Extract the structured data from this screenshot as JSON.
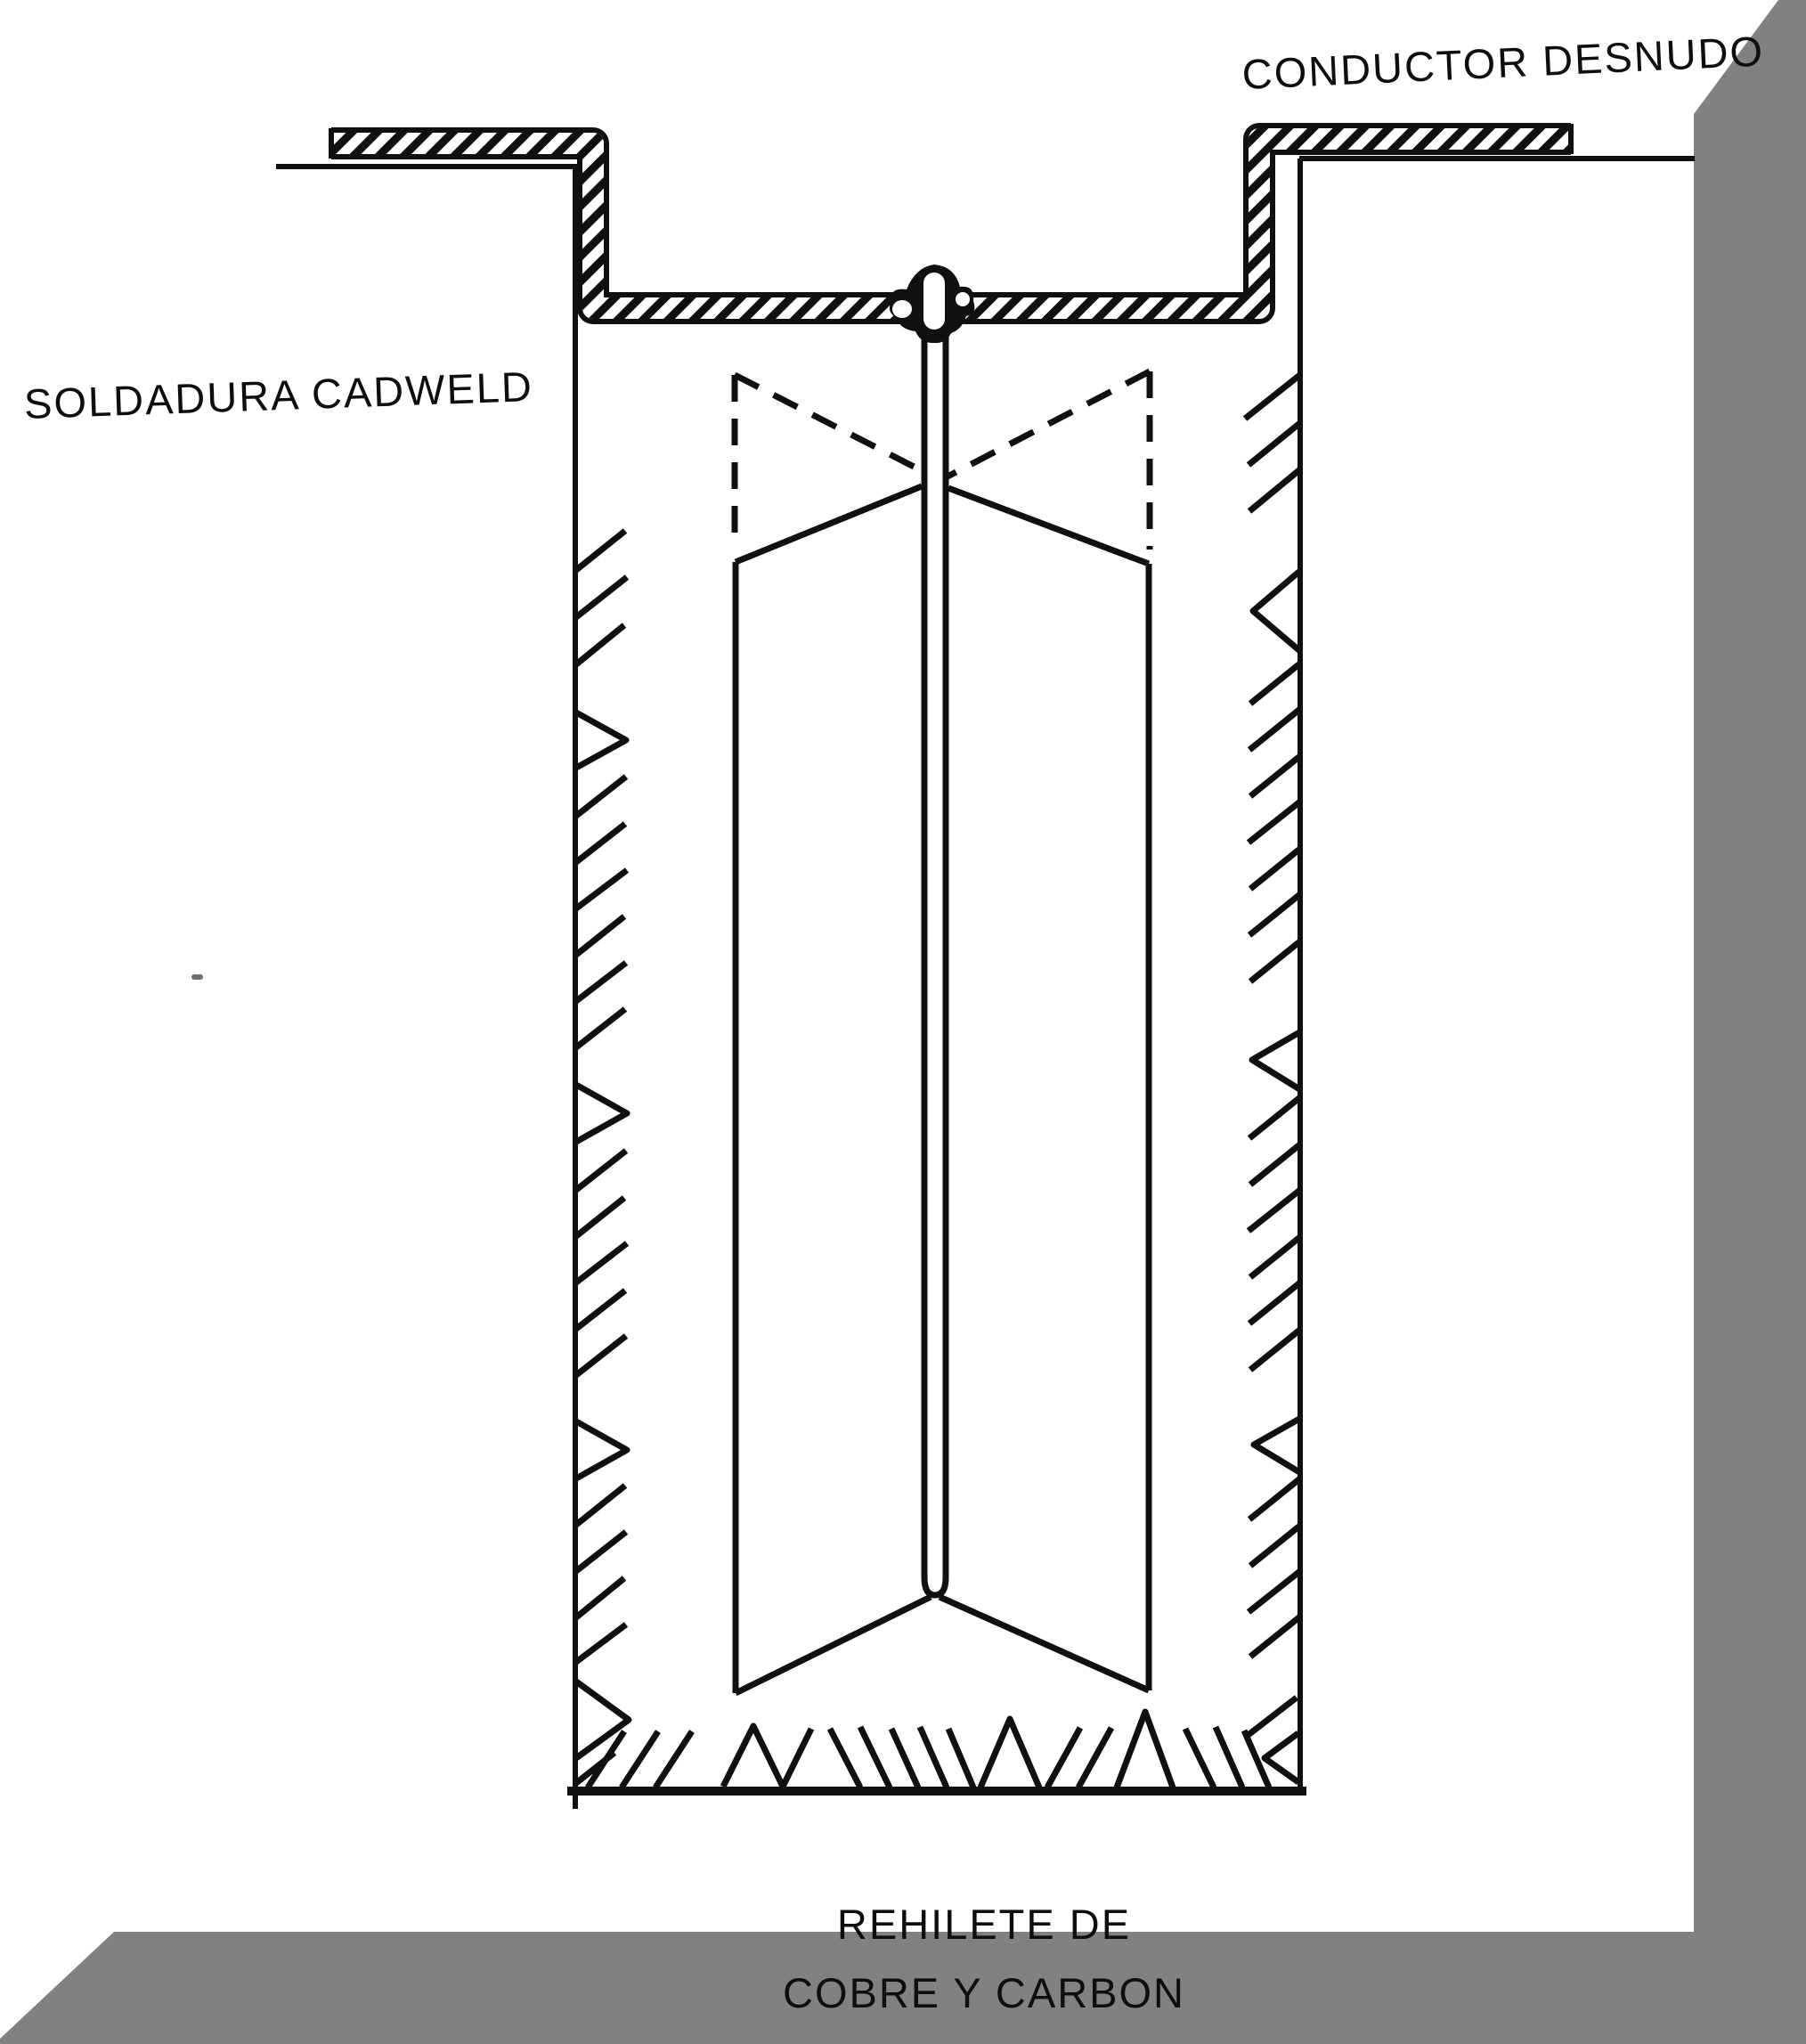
{
  "labels": {
    "conductor": "CONDUCTOR DESNUDO",
    "soldadura": "SOLDADURA CADWELD",
    "rehilete_line1": "REHILETE DE",
    "rehilete_line2": "COBRE Y CARBON"
  },
  "colors": {
    "paper": "#ffffff",
    "ink": "#101010",
    "shadow_gray": "#818181"
  },
  "diagram": {
    "type": "technical-line-drawing",
    "subject": "grounding electrode trench cross-section"
  }
}
